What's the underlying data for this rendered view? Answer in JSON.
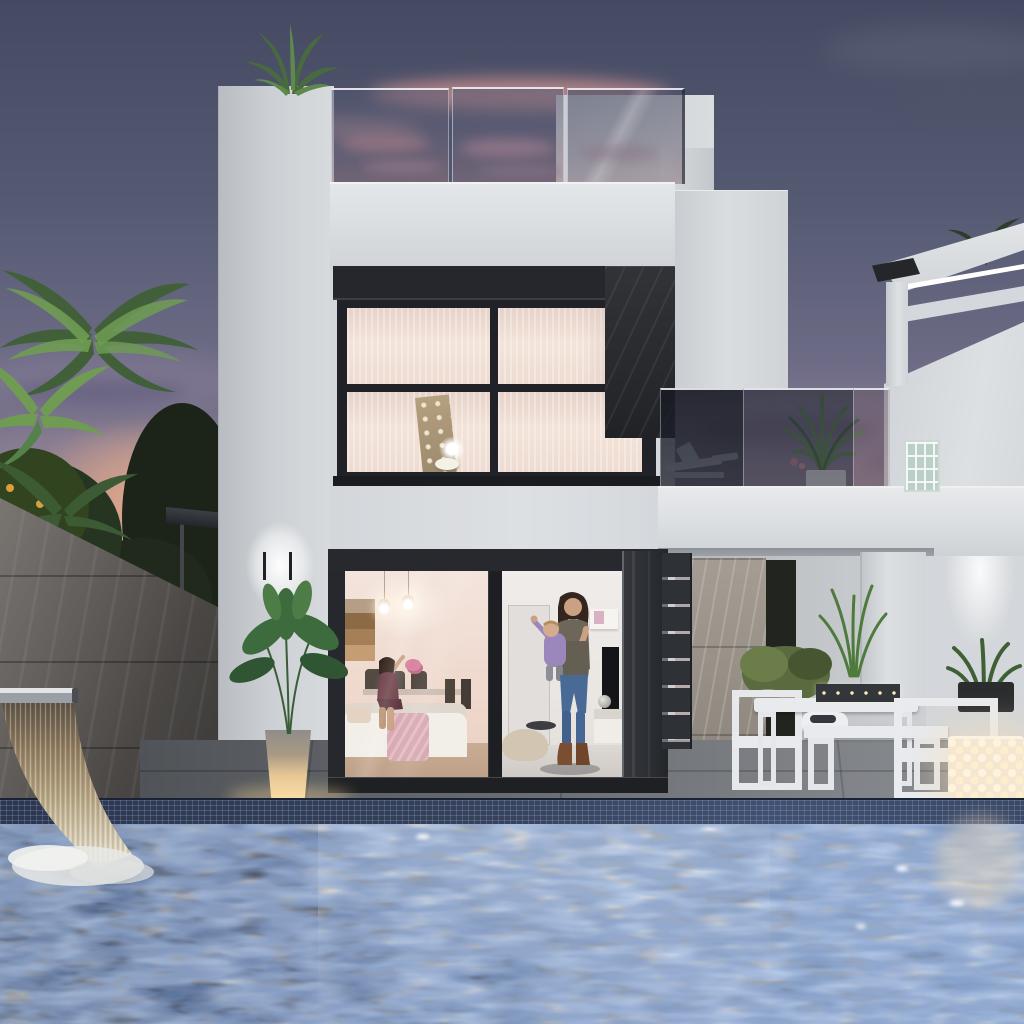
{
  "scene": {
    "labels": {
      "root": "modern two-storey villa with swimming pool at dusk",
      "sky": "dusk sky with pink and purple clouds",
      "palm-trees": "palm trees and hedge on the left",
      "stone-wall": "dark stone boundary wall",
      "waterfall": "stainless steel waterfall blade spilling into pool",
      "outdoor-shower": "wall mounted outdoor shower",
      "villa": "white villa facade",
      "rooftop-railing": "rooftop terrace glass railing",
      "upper-window": "first floor window with lit interior",
      "stone-panel": "dark stone accent cladding",
      "balcony": "first floor balcony with glass railing and plants",
      "neighbor-house": "neighbouring white house with lit pergola",
      "glass-blocks": "glass block window",
      "wall-lamp": "glowing up-down wall lamp",
      "sliding-door": "ground floor sliding glass door",
      "living-room": "lit living and dining room interior",
      "seated-woman": "woman seated on sofa waving",
      "mother-and-baby": "woman standing in doorway holding a baby",
      "louver-door": "dark louvered side door",
      "terrace": "covered terrace with outdoor dining set",
      "outdoor-dining": "white outdoor dining table, chairs and bench",
      "lantern": "perforated white glowing lantern",
      "plant-pot": "glowing planter with green plant",
      "deck": "grey stone pool deck",
      "pool": "swimming pool with rippled reflections"
    },
    "palette": {
      "sky-top": "#454a62",
      "sky-horizon": "#c49a8e",
      "sunset": "#f0b08b",
      "cloud-pink": "#c98f8d",
      "wall-lit": "#dcdfe2",
      "wall-mid": "#c6cacd",
      "wall-shade": "#aeb2b8",
      "frame-dark": "#25272c",
      "panel-dark": "#2b2d32",
      "boundary-wall": "#5a5653",
      "interior-warm": "#f3e4dc",
      "interior-deep": "#e9cfc4",
      "glow": "#ffffff",
      "pot-glow": "#f6dfae",
      "lantern": "#f4e7d2",
      "water-dark": "#222a3c",
      "water-mid": "#6a7891",
      "water-light": "#9db1c9",
      "water-bright": "#e9e2d0",
      "mosaic": "#333e57",
      "deck": "#6e7176",
      "foliage-lit": "#6f9c52",
      "foliage-dark": "#2e4128",
      "jeans": "#4a6a96",
      "skin": "#caa183",
      "hair": "#35261d",
      "dress": "#6e4049",
      "baby": "#9b87bb",
      "throw-pink": "#d9a9b2",
      "wood": "#c49d72"
    }
  }
}
